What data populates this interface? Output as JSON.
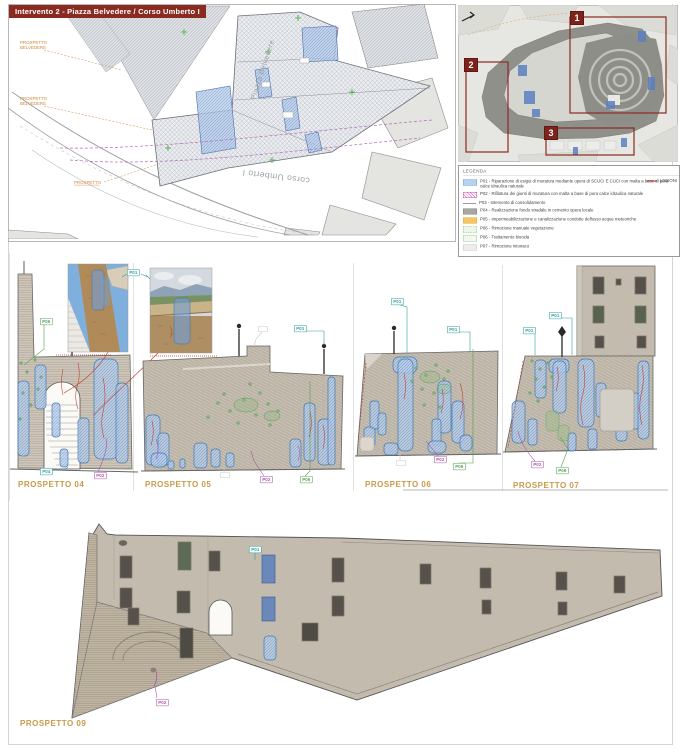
{
  "sheet": {
    "title": "Intervento 2 - Piazza Belvedere / Corso Umberto I"
  },
  "plan": {
    "piazza": "Piazza Belvedere",
    "street": "corso Umberto I",
    "callout1_line1": "PROSPETTO",
    "callout1_line2": "BELVEDERE",
    "callout2_line1": "PROSPETTO",
    "callout2_line2": "BELVEDERE",
    "callout3": "PROSPETTO"
  },
  "keyplan": {
    "zone1": "1",
    "zone2": "2",
    "zone3": "3"
  },
  "legend": {
    "title": "LEGENDA",
    "items": [
      {
        "label": "P01 - Riparazione di esigui di muratura mediante opera di SCUCI E CUCI con malta a base di pura calce idraulica naturale"
      },
      {
        "label": "P02 - Rifilatura dei giunti di muratura con malta a base di pura calce idraulica naturale"
      },
      {
        "label": "P03 - Intervento di consolidamento"
      },
      {
        "label": "P04 - Realizzazione fondo stradale in cemento opera locale"
      },
      {
        "label": "P05 - Impermeabilizzazione e canalizzazione condotte deflusso acque meteoriche"
      },
      {
        "label": "P06 - Rimozione manuale vegetazione"
      },
      {
        "label": "P06 - Trattamento biocida"
      },
      {
        "label": "P07 - Rimozione intonaco"
      }
    ],
    "lesioni": "LESIONI"
  },
  "tags": {
    "p01": "P01",
    "p02": "P02",
    "p04": "P04",
    "p06": "P06"
  },
  "elevations": {
    "e04": {
      "title": "PROSPETTO 04"
    },
    "e05": {
      "title": "PROSPETTO 05"
    },
    "e06": {
      "title": "PROSPETTO 06"
    },
    "e07": {
      "title": "PROSPETTO 07"
    },
    "e09": {
      "title": "PROSPETTO 09"
    }
  },
  "colors": {
    "banner_red": "#8a2b22",
    "zone_red": "#7e221c",
    "tag_teal": "#2e9e9e",
    "tag_purple": "#a855a8",
    "tag_green": "#55a055",
    "title_tan": "#c89a4a",
    "patch_blue": "#4179b4",
    "lesion_red": "#c0392b",
    "legend_blue": "#b8d4ec",
    "legend_orange": "#f6c75c"
  }
}
